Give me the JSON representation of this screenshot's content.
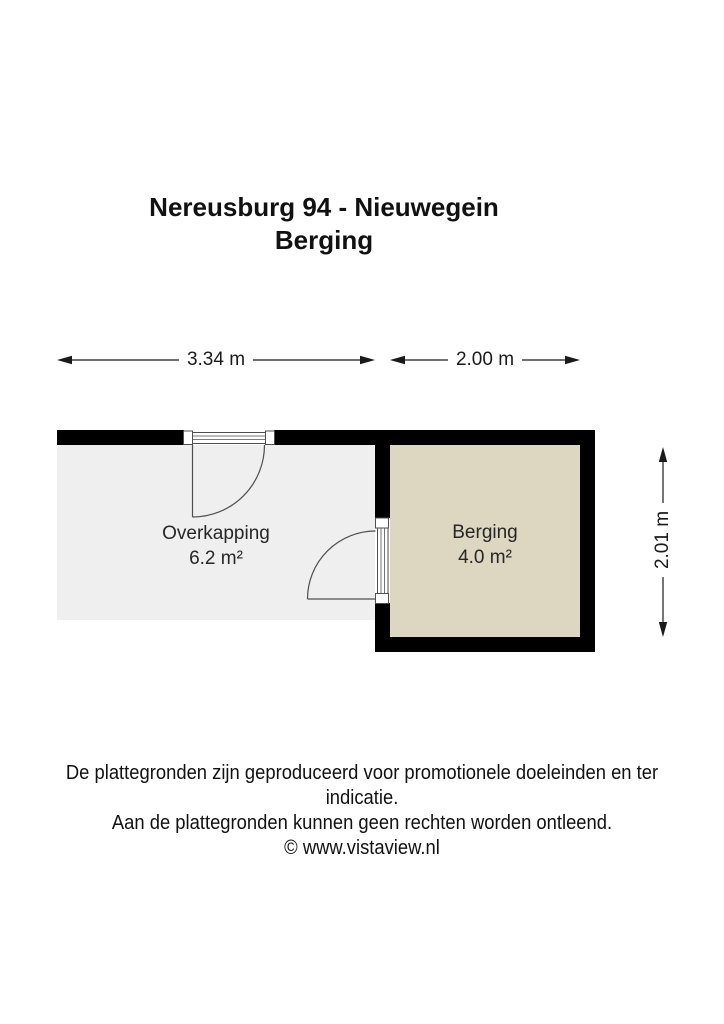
{
  "title": {
    "line1": "Nereusburg 94 - Nieuwegein",
    "line2": "Berging"
  },
  "dimensions": {
    "overkapping_width": "3.34 m",
    "berging_width": "2.00 m",
    "berging_height": "2.01 m"
  },
  "rooms": {
    "overkapping": {
      "name": "Overkapping",
      "area": "6.2 m²"
    },
    "berging": {
      "name": "Berging",
      "area": "4.0 m²"
    }
  },
  "footer": {
    "line1": "De plattegronden zijn geproduceerd voor promotionele doeleinden en ter indicatie.",
    "line2": "Aan de plattegronden kunnen geen rechten worden ontleend.",
    "line3": "© www.vistaview.nl"
  },
  "colors": {
    "wall": "#000000",
    "overkapping_fill": "#efefef",
    "berging_fill": "#ddd6c1",
    "door_line": "#4f4f4f",
    "arrow": "#1a1a1a"
  }
}
